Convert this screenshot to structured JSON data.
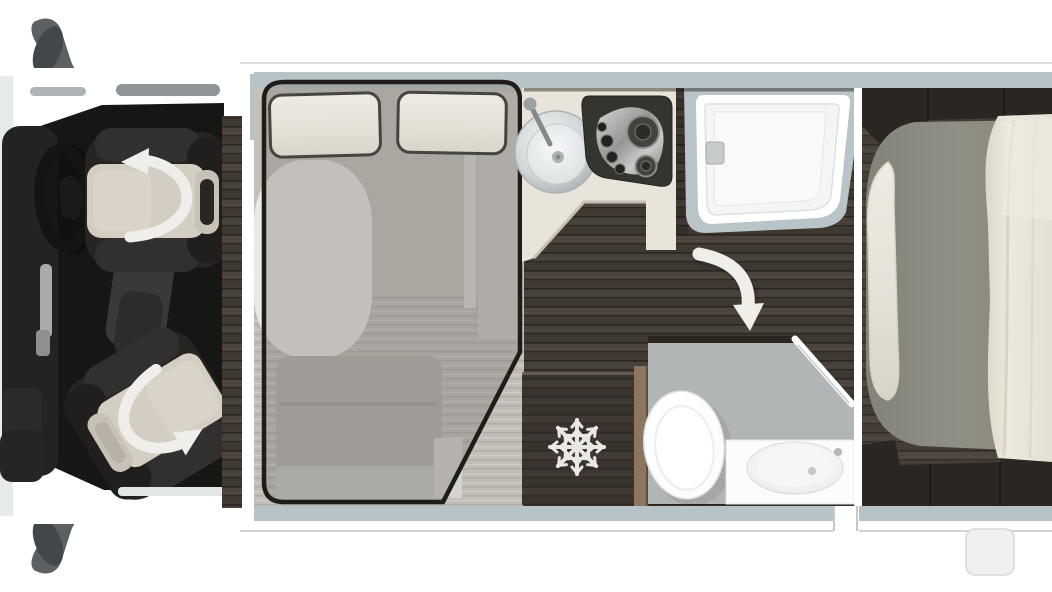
{
  "diagram": {
    "title": "Motorhome floor plan - top view",
    "type": "floor-plan",
    "areas": {
      "cab": {
        "label": "driver cab",
        "items": [
          "left-wing-mirror",
          "right-wing-mirror",
          "dashboard",
          "steering-wheel",
          "driver-swivel-seat",
          "passenger-swivel-seat"
        ],
        "annotations": [
          "seat-swivel-arrow",
          "seat-swivel-arrow"
        ]
      },
      "lounge": {
        "label": "dinette with drop-down bed",
        "items": [
          "drop-down-bed-outline",
          "pillow",
          "pillow",
          "dinette-table",
          "bench-seat",
          "side-step"
        ]
      },
      "kitchen": {
        "label": "kitchenette",
        "items": [
          "round-sink",
          "faucet",
          "three-burner-hob"
        ]
      },
      "shower": {
        "label": "shower cubicle",
        "items": [
          "shower-tray",
          "drain"
        ]
      },
      "washroom": {
        "label": "washroom",
        "items": [
          "refrigerator",
          "toilet",
          "washbasin-counter",
          "washbasin",
          "door-swing-arrow"
        ]
      },
      "bedroom": {
        "label": "rear bedroom",
        "items": [
          "mattress",
          "pillow",
          "duvet",
          "overhead-cabinets",
          "foot-cabinets"
        ]
      },
      "entrance": {
        "label": "entry door gap",
        "items": [
          "door-opening",
          "exterior-step"
        ]
      }
    },
    "icons": [
      "swivel-arrow-icon",
      "swivel-arrow-icon",
      "door-swing-arrow-icon",
      "snowflake-icon",
      "burner-icon",
      "drain-icon"
    ]
  },
  "palette": {
    "bg": "#ffffff",
    "coachWhite": "#ffffff",
    "coachWall": "#b7c3c7",
    "cabFloor": "#161614",
    "seatDark": "#262522",
    "seatCushion": "#d4cec2",
    "cream": "#e7e3d8",
    "tableTop": "#ebe9e3",
    "counterTop": "#e9e4da",
    "benchGray": "#b3b1ad",
    "bathFloor": "#b2b5b6",
    "showerWall": "#b9c4c8",
    "mattressGray": "#8d8c82",
    "fridgeWood": "#342d28",
    "sideWood": "#8d7660",
    "mirrorGray": "#5c6062",
    "hobDark": "#36342f",
    "outline": "#1e1d1b",
    "arrowWhite": "#efeeea",
    "snowWhite": "#e8e8e4",
    "woodFloor": "#453d37"
  }
}
